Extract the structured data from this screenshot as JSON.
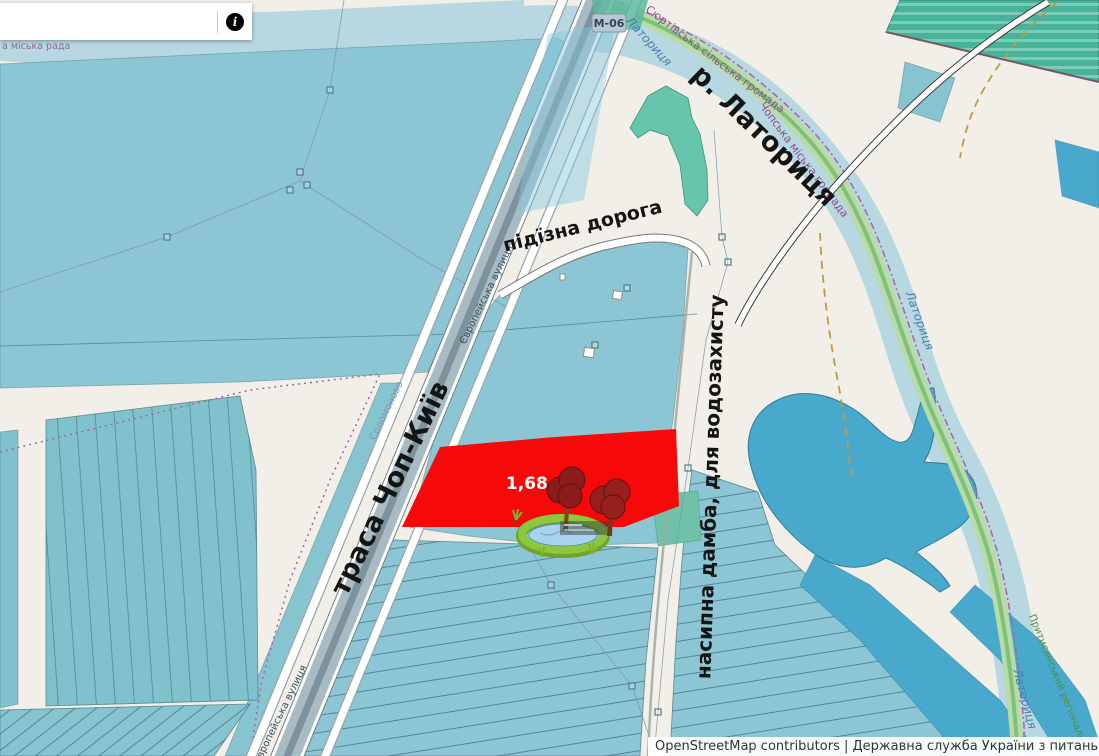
{
  "search": {
    "value": "",
    "info_glyph": "i"
  },
  "attribution": "OpenStreetMap contributors | Державна служба України з питань геодезії, картогр",
  "parcel": {
    "area_label": "1,68 га"
  },
  "annotations": {
    "highway": "траса Чоп-Київ",
    "access_road": "підїзна дорога",
    "river": "р. Латориця",
    "dam": "насипна дамба, для водозахисту"
  },
  "map_labels": {
    "road_ref": "М-06",
    "river_name": "Латориця",
    "street": "Європейська вулиця",
    "settlement": "Соломоново",
    "hromada_surtivska": "Сюртівська сільська громада",
    "hromada_chopska": "Чопська міська громада",
    "rada_fragment": "а міська рада",
    "park": "Притисянський регіональний"
  },
  "colors": {
    "background": "#f2efe9",
    "field_blue": "#8cc6d4",
    "field_teal": "#7fc2cb",
    "water_dark": "#49a9cd",
    "river": "#b7d7e1",
    "green_zone": "#46b39a",
    "parcel_red": "#f60909",
    "boundary_purple": "#a863a8",
    "annotation_black": "#141414"
  }
}
